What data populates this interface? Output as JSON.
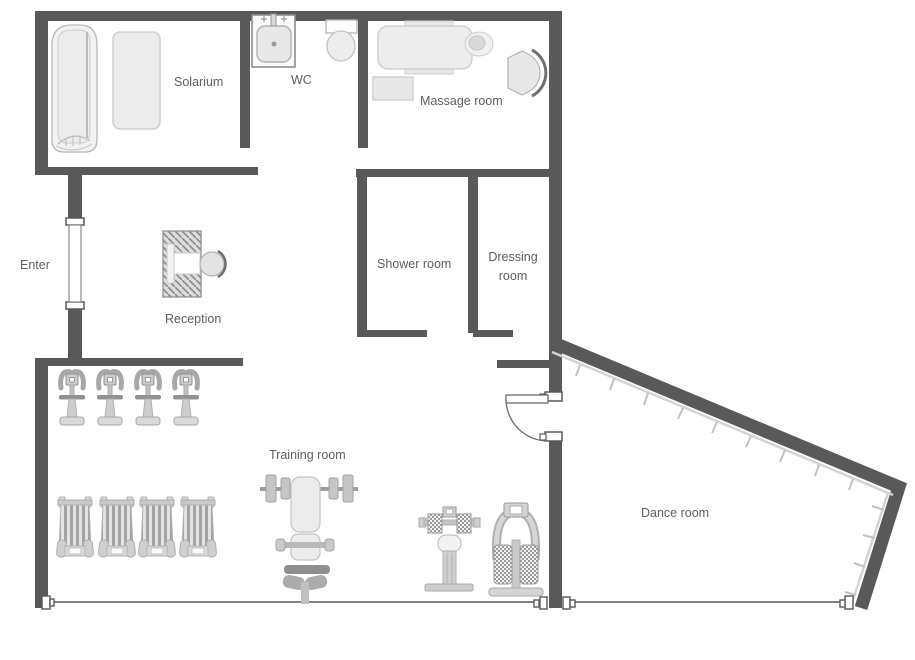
{
  "plan": {
    "rooms": [
      {
        "id": "solarium",
        "label": "Solarium"
      },
      {
        "id": "wc",
        "label": "WC"
      },
      {
        "id": "massage",
        "label": "Massage room"
      },
      {
        "id": "enter",
        "label": "Enter"
      },
      {
        "id": "reception",
        "label": "Reception"
      },
      {
        "id": "shower",
        "label": "Shower room"
      },
      {
        "id": "dressing",
        "label": "Dressing room"
      },
      {
        "id": "training",
        "label": "Training room"
      },
      {
        "id": "dance",
        "label": "Dance room"
      }
    ],
    "colors": {
      "wall": "#595959",
      "thin_wall": "#6e6e6e",
      "furniture_light": "#ededed",
      "furniture_mid": "#d6d6d6",
      "furniture_dark": "#8f8f8f",
      "outline": "#b3b3b3",
      "label_text": "#5e5e5e",
      "background": "#ffffff"
    },
    "icons": [
      {
        "name": "solarium-bed-icon",
        "count": 1
      },
      {
        "name": "solarium-mat-icon",
        "count": 1
      },
      {
        "name": "sink-icon",
        "count": 1
      },
      {
        "name": "toilet-icon",
        "count": 1
      },
      {
        "name": "massage-table-icon",
        "count": 1
      },
      {
        "name": "side-table-icon",
        "count": 1
      },
      {
        "name": "chair-icon",
        "count": 2
      },
      {
        "name": "reception-desk-icon",
        "count": 1
      },
      {
        "name": "exercise-bike-icon",
        "count": 4
      },
      {
        "name": "treadmill-icon",
        "count": 4
      },
      {
        "name": "bench-press-icon",
        "count": 1
      },
      {
        "name": "weight-machine-icon",
        "count": 2
      },
      {
        "name": "door-icon",
        "count": 2
      },
      {
        "name": "wall-connector-icon",
        "count": 4
      },
      {
        "name": "mirror-wall-ticks-icon",
        "count": 1
      }
    ]
  }
}
